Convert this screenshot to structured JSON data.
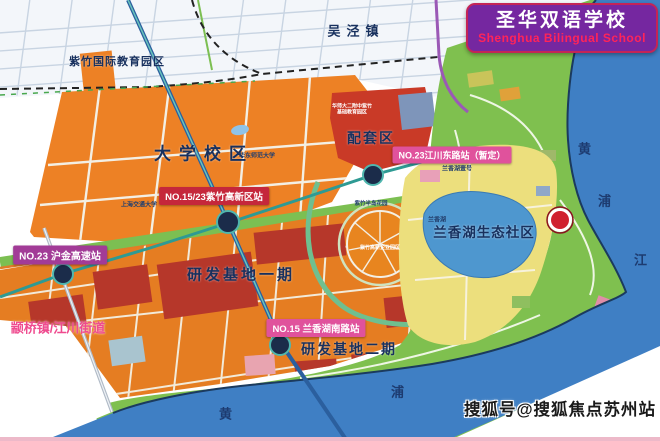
{
  "header": {
    "school_cn": "圣华双语学校",
    "school_en": "Shenghua Bilingual School"
  },
  "map": {
    "zone_labels": [
      {
        "text": "吴泾镇"
      },
      {
        "text": "紫竹国际教育园区"
      },
      {
        "text": "大学校区"
      },
      {
        "text": "配套区"
      },
      {
        "text": "研发基地一期"
      },
      {
        "text": "研发基地二期"
      },
      {
        "text": "兰香湖生态社区"
      },
      {
        "text": "颛桥镇/江川街道"
      }
    ],
    "station_labels": [
      {
        "text": "NO.23 沪金高速站"
      },
      {
        "text": "NO.15/23紫竹高新区站"
      },
      {
        "text": "NO.23江川东路站（暂定）"
      },
      {
        "text": "NO.15 兰香湖南路站"
      }
    ],
    "river_labels": [
      {
        "text": "黄"
      },
      {
        "text": "浦"
      },
      {
        "text": "江"
      },
      {
        "text": "浦"
      },
      {
        "text": "黄"
      }
    ],
    "poi_labels": [
      {
        "text": "上海交通大学"
      },
      {
        "text": "华东师范大学"
      },
      {
        "text": "紫竹半岛花园"
      },
      {
        "text": "兰香湖壹号"
      },
      {
        "text": "兰香湖"
      },
      {
        "text": "华师大二附中紫竹基础教育园区"
      },
      {
        "text": "紫竹高新企业园区"
      }
    ]
  },
  "watermark": {
    "text": "搜狐号@搜狐焦点苏州站"
  },
  "colors": {
    "title_bg": "#7527a0",
    "title_en_text": "#ff2459",
    "station_red": "#c5273b",
    "station_pink": "#e0529c",
    "station_purple": "#a23b97",
    "river_blue": "#3f7fc4",
    "lake_blue": "#4e97cf",
    "park_green": "#7fc04f",
    "campus_orange": "#ed8125",
    "zone_crimson": "#b6372a",
    "zone_yellow": "#ecdf7d",
    "town_label_pink": "#ef4b8f",
    "marker_red": "#d0202e"
  }
}
